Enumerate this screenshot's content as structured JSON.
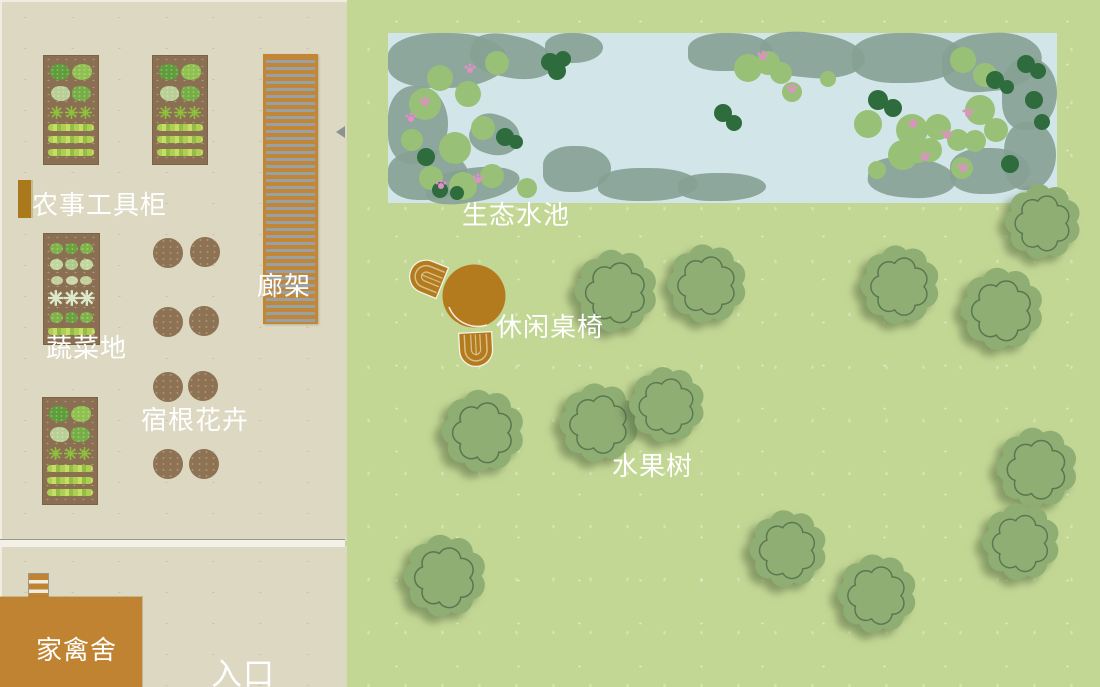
{
  "title": "家庭农场庭院平面图",
  "labels": {
    "tool_cabinet": "农事工具柜",
    "pergola": "廊架",
    "vegetable_plot": "蔬菜地",
    "perennial_flowers": "宿根花卉",
    "poultry_house": "家禽舍",
    "entrance": "入口",
    "eco_pond": "生态水池",
    "leisure_table_chairs": "休闲桌椅",
    "fruit_trees": "水果树"
  },
  "colors": {
    "panel_beige": "#dcd8c2",
    "lawn_green": "#c3d795",
    "pond_water": "#d2e6e9",
    "reed": "#87a295",
    "lily_pad": "#98c177",
    "dark_foliage": "#2e6b3d",
    "pink_flower": "#e08fc7",
    "tree_fill": "#8fae74",
    "tree_line": "#5a7750",
    "bed_soil": "#8a6f52",
    "pergola_wood": "#c28736",
    "pergola_slat": "#98a2a6",
    "furniture_wood": "#b47b1e",
    "building_wood": "#c08331",
    "label_text": "#ffffff"
  },
  "map": {
    "beds": [
      {
        "x": 43,
        "y": 55,
        "w": 56,
        "h": 110,
        "rows": [
          "bush2a",
          "bush2b",
          "spiky3",
          "strip",
          "strip",
          "strip"
        ]
      },
      {
        "x": 152,
        "y": 55,
        "w": 56,
        "h": 110,
        "rows": [
          "bush2a",
          "bush2b",
          "spiky3",
          "strip",
          "strip",
          "strip"
        ]
      },
      {
        "x": 43,
        "y": 233,
        "w": 57,
        "h": 112,
        "rows": [
          "lettuce3",
          "lettuce3pale",
          "sprig3",
          "star3",
          "lettuce3",
          "strip"
        ]
      },
      {
        "x": 42,
        "y": 397,
        "w": 56,
        "h": 108,
        "rows": [
          "bush2a",
          "bush2b",
          "spiky3",
          "strip",
          "strip",
          "strip"
        ]
      }
    ],
    "planters": [
      [
        168,
        253
      ],
      [
        205,
        252
      ],
      [
        168,
        322
      ],
      [
        204,
        321
      ],
      [
        168,
        387
      ],
      [
        203,
        386
      ],
      [
        168,
        464
      ],
      [
        204,
        464
      ]
    ],
    "planter_r": 15,
    "pergola": {
      "x": 263,
      "y": 54,
      "w": 55,
      "h": 270
    },
    "cabinet": {
      "x": 18,
      "y": 180,
      "w": 13,
      "h": 38
    },
    "ladder": {
      "x": 28,
      "y": 573,
      "w": 19,
      "h": 26
    },
    "poultry": {
      "x": 0,
      "y": 597,
      "w": 142,
      "h": 90
    },
    "gate_marker": {
      "x": 336,
      "y": 126
    },
    "pond": {
      "x": 388,
      "y": 33,
      "w": 669,
      "h": 170
    },
    "reeds": [
      [
        388,
        33,
        120,
        55,
        0
      ],
      [
        470,
        36,
        85,
        42,
        12
      ],
      [
        388,
        86,
        60,
        78,
        0
      ],
      [
        388,
        150,
        80,
        50,
        0
      ],
      [
        425,
        168,
        95,
        34,
        -8
      ],
      [
        545,
        33,
        58,
        30,
        0
      ],
      [
        470,
        115,
        50,
        40,
        18
      ],
      [
        688,
        33,
        85,
        38,
        0
      ],
      [
        760,
        33,
        105,
        45,
        6
      ],
      [
        852,
        33,
        112,
        50,
        0
      ],
      [
        942,
        33,
        100,
        58,
        -5
      ],
      [
        1002,
        58,
        55,
        72,
        0
      ],
      [
        1004,
        122,
        52,
        68,
        0
      ],
      [
        950,
        148,
        80,
        46,
        0
      ],
      [
        868,
        158,
        88,
        40,
        5
      ],
      [
        543,
        146,
        68,
        46,
        0
      ],
      [
        598,
        168,
        100,
        33,
        0
      ],
      [
        678,
        173,
        88,
        28,
        0
      ]
    ],
    "lily_pads": [
      [
        440,
        78,
        13
      ],
      [
        425,
        104,
        16
      ],
      [
        468,
        94,
        13
      ],
      [
        412,
        140,
        11
      ],
      [
        455,
        148,
        16
      ],
      [
        483,
        128,
        12
      ],
      [
        497,
        63,
        12
      ],
      [
        431,
        178,
        12
      ],
      [
        463,
        186,
        14
      ],
      [
        492,
        176,
        12
      ],
      [
        527,
        188,
        10
      ],
      [
        748,
        68,
        14
      ],
      [
        768,
        63,
        12
      ],
      [
        781,
        73,
        11
      ],
      [
        792,
        92,
        10
      ],
      [
        985,
        75,
        12
      ],
      [
        963,
        60,
        13
      ],
      [
        912,
        130,
        16
      ],
      [
        938,
        127,
        13
      ],
      [
        918,
        151,
        12
      ],
      [
        980,
        110,
        15
      ],
      [
        996,
        130,
        12
      ],
      [
        975,
        141,
        11
      ],
      [
        868,
        124,
        14
      ],
      [
        903,
        155,
        15
      ],
      [
        930,
        150,
        12
      ],
      [
        958,
        140,
        11
      ],
      [
        962,
        168,
        11
      ],
      [
        877,
        170,
        9
      ],
      [
        828,
        79,
        8
      ]
    ],
    "dark_blobs": [
      [
        550,
        62,
        9
      ],
      [
        563,
        59,
        8
      ],
      [
        557,
        71,
        9
      ],
      [
        505,
        137,
        9
      ],
      [
        516,
        142,
        7
      ],
      [
        426,
        157,
        9
      ],
      [
        440,
        190,
        8
      ],
      [
        457,
        193,
        7
      ],
      [
        723,
        113,
        9
      ],
      [
        734,
        123,
        8
      ],
      [
        878,
        100,
        10
      ],
      [
        893,
        108,
        9
      ],
      [
        995,
        80,
        9
      ],
      [
        1007,
        87,
        7
      ],
      [
        1026,
        64,
        9
      ],
      [
        1038,
        71,
        8
      ],
      [
        1034,
        100,
        9
      ],
      [
        1042,
        122,
        8
      ],
      [
        1010,
        164,
        9
      ]
    ],
    "pink_flowers": [
      [
        470,
        70
      ],
      [
        411,
        119
      ],
      [
        478,
        180
      ],
      [
        441,
        186
      ],
      [
        763,
        57
      ],
      [
        913,
        125
      ],
      [
        947,
        136
      ],
      [
        968,
        114
      ],
      [
        925,
        158
      ],
      [
        963,
        169
      ],
      [
        425,
        103
      ],
      [
        792,
        90
      ]
    ],
    "trees": [
      [
        616,
        288,
        96
      ],
      [
        707,
        281,
        92
      ],
      [
        900,
        282,
        92
      ],
      [
        1002,
        306,
        96
      ],
      [
        1043,
        219,
        88
      ],
      [
        483,
        428,
        96
      ],
      [
        599,
        420,
        92
      ],
      [
        667,
        402,
        88
      ],
      [
        445,
        573,
        96
      ],
      [
        788,
        546,
        90
      ],
      [
        877,
        591,
        92
      ],
      [
        1037,
        465,
        94
      ],
      [
        1021,
        539,
        90
      ]
    ],
    "table": {
      "cx": 474,
      "cy": 296,
      "r": 32
    },
    "chairs": [
      {
        "cx": 427,
        "cy": 277,
        "rot": 112
      },
      {
        "cx": 476,
        "cy": 349,
        "rot": -3
      }
    ]
  }
}
